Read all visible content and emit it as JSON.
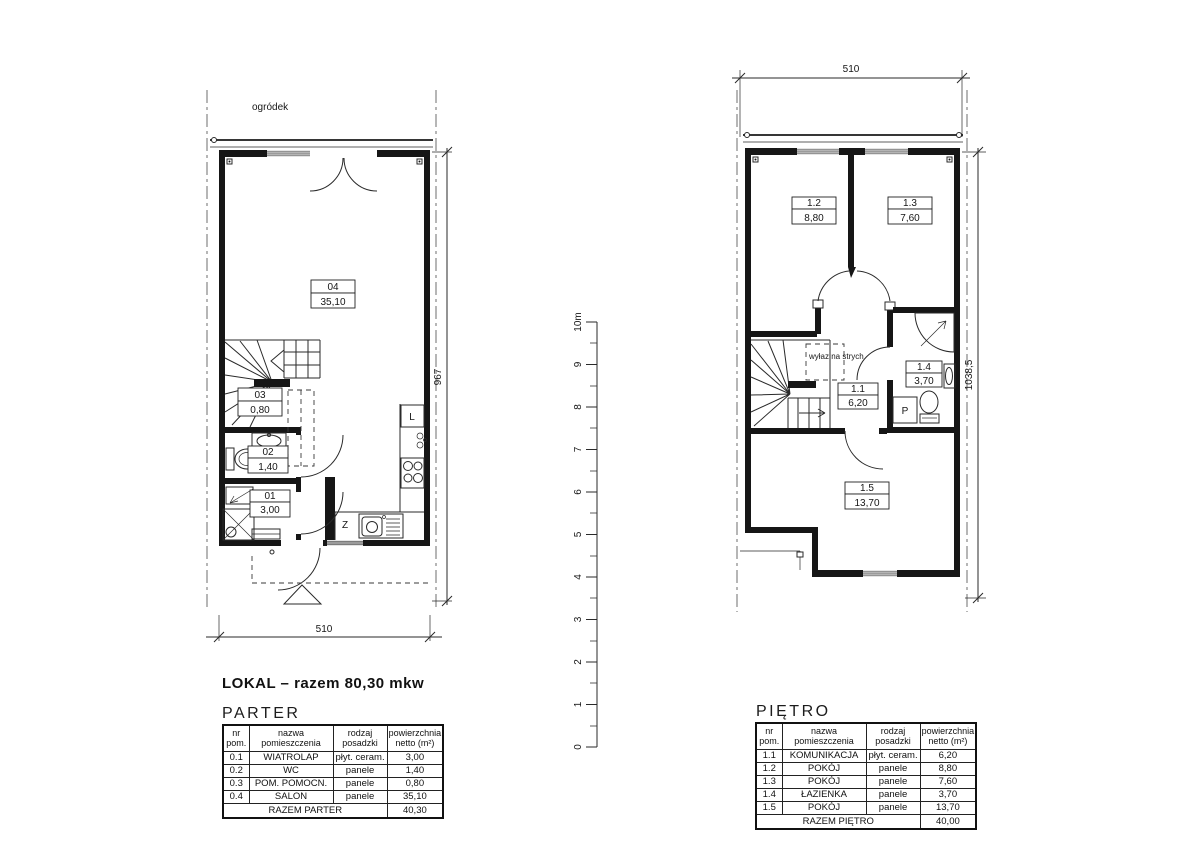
{
  "lokal_summary": "LOKAL – razem 80,30 mkw",
  "scale_bar": {
    "ticks": [
      "0",
      "1",
      "2",
      "3",
      "4",
      "5",
      "6",
      "7",
      "8",
      "9",
      "10m"
    ]
  },
  "parter": {
    "heading": "PARTER",
    "garden_label": "ogródek",
    "dim_width": "510",
    "dim_height": "967",
    "labels": {
      "salon_id": "04",
      "salon_area": "35,10",
      "pom_id": "03",
      "pom_area": "0,80",
      "wc_id": "02",
      "wc_area": "1,40",
      "wiatrolap_id": "01",
      "wiatrolap_area": "3,00",
      "fridge": "L",
      "sink": "Z"
    },
    "table": {
      "headers": [
        "nr\npom.",
        "nazwa pomieszczenia",
        "rodzaj\nposadzki",
        "powierzchnia\nnetto (m²)"
      ],
      "rows": [
        {
          "nr": "0.1",
          "name": "WIATROLAP",
          "floor": "płyt. ceram.",
          "area": "3,00"
        },
        {
          "nr": "0.2",
          "name": "WC",
          "floor": "panele",
          "area": "1,40"
        },
        {
          "nr": "0.3",
          "name": "POM. POMOCN.",
          "floor": "panele",
          "area": "0,80"
        },
        {
          "nr": "0.4",
          "name": "SALON",
          "floor": "panele",
          "area": "35,10"
        }
      ],
      "total_label": "RAZEM PARTER",
      "total_value": "40,30"
    }
  },
  "pietro": {
    "heading": "PIĘTRO",
    "dim_width": "510",
    "dim_height": "1038,5",
    "labels": {
      "komunikacja_id": "1.1",
      "komunikacja_area": "6,20",
      "pokoj2_id": "1.2",
      "pokoj2_area": "8,80",
      "pokoj3_id": "1.3",
      "pokoj3_area": "7,60",
      "lazienka_id": "1.4",
      "lazienka_area": "3,70",
      "pokoj5_id": "1.5",
      "pokoj5_area": "13,70",
      "attic": "wyłaz na strych",
      "washer": "P"
    },
    "table": {
      "headers": [
        "nr\npom.",
        "nazwa pomieszczenia",
        "rodzaj\nposadzki",
        "powierzchnia\nnetto (m²)"
      ],
      "rows": [
        {
          "nr": "1.1",
          "name": "KOMUNIKACJA",
          "floor": "płyt. ceram.",
          "area": "6,20"
        },
        {
          "nr": "1.2",
          "name": "POKÓJ",
          "floor": "panele",
          "area": "8,80"
        },
        {
          "nr": "1.3",
          "name": "POKÓJ",
          "floor": "panele",
          "area": "7,60"
        },
        {
          "nr": "1.4",
          "name": "ŁAZIENKA",
          "floor": "panele",
          "area": "3,70"
        },
        {
          "nr": "1.5",
          "name": "POKÓJ",
          "floor": "panele",
          "area": "13,70"
        }
      ],
      "total_label": "RAZEM PIĘTRO",
      "total_value": "40,00"
    }
  }
}
